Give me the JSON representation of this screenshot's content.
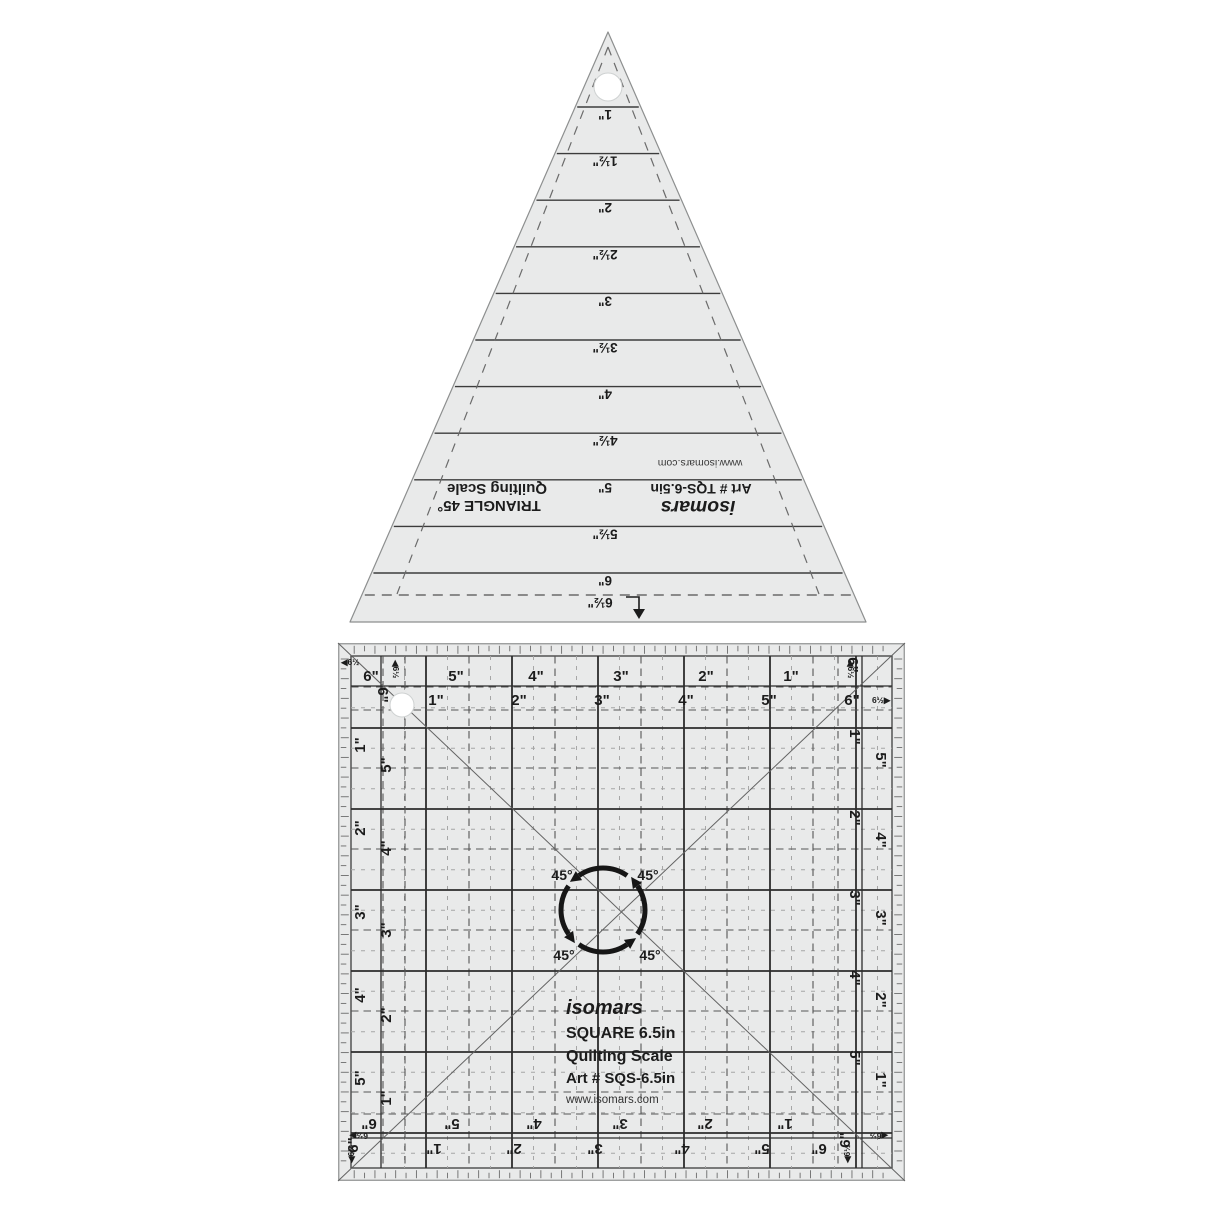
{
  "colors": {
    "background": "#ffffff",
    "ruler_body": "#e9eaea",
    "line_dark": "#3c3c3c",
    "line_mid": "#6b6b6b",
    "line_light": "#a6a6a6",
    "text": "#1c1c1c"
  },
  "triangle_ruler": {
    "marks": [
      "1\"",
      "1½\"",
      "2\"",
      "2½\"",
      "3\"",
      "3½\"",
      "4\"",
      "4½\"",
      "5\"",
      "5½\"",
      "6\"",
      "6½\""
    ],
    "title_line1": "TRIANGLE 45°",
    "title_line2": "Quilting Scale",
    "brand": "isomars",
    "art_no": "Art # TQS-6.5in",
    "website": "www.isomars.com"
  },
  "square_ruler": {
    "brand": "isomars",
    "product": "SQUARE 6.5in",
    "scale_label": "Quilting Scale",
    "art_no": "Art # SQS-6.5in",
    "website": "www.isomars.com",
    "angle_label": "45°",
    "corner_label_left": "◀6½",
    "corner_label_right": "6½▶",
    "corner_six": "6\"",
    "top_outer": [
      "6\"",
      "5\"",
      "4\"",
      "3\"",
      "2\"",
      "1\""
    ],
    "top_inner": [
      "1\"",
      "2\"",
      "3\"",
      "4\"",
      "5\"",
      "6\""
    ],
    "left_outer": [
      "1\"",
      "2\"",
      "3\"",
      "4\"",
      "5\""
    ],
    "left_inner": [
      "5\"",
      "4\"",
      "3\"",
      "2\"",
      "1\""
    ],
    "right_inner": [
      "1\"",
      "2\"",
      "3\"",
      "4\"",
      "5\""
    ],
    "right_outer": [
      "5\"",
      "4\"",
      "3\"",
      "2\"",
      "1\""
    ],
    "bottom_inner": [
      "6\"",
      "5\"",
      "4\"",
      "3\"",
      "2\"",
      "1\""
    ],
    "bottom_outer": [
      "1\"",
      "2\"",
      "3\"",
      "4\"",
      "5\"",
      "6\""
    ]
  }
}
